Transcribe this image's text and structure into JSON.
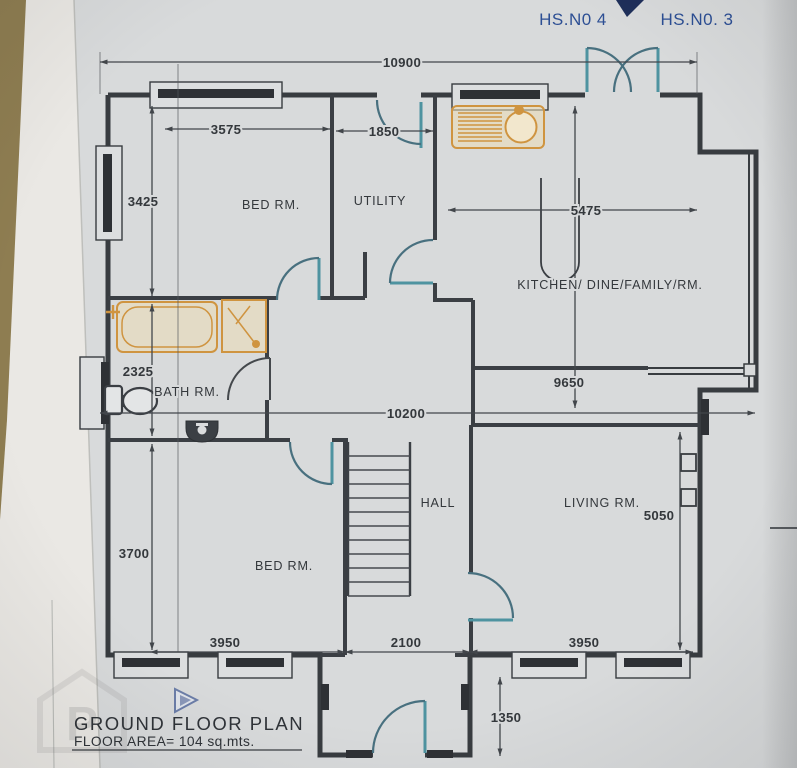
{
  "annotations": {
    "hs_no_4": "HS.N0 4",
    "hs_no_3": "HS.N0. 3"
  },
  "rooms": {
    "bed_front": "BED RM.",
    "utility": "UTILITY",
    "kitchen": "KITCHEN/ DINE/FAMILY/RM.",
    "bath": "BATH RM.",
    "hall": "HALL",
    "living": "LIVING RM.",
    "bed_back": "BED RM."
  },
  "dimensions": {
    "overall_width": "10900",
    "front_bed_width": "3575",
    "utility_width": "1850",
    "front_bed_depth": "3425",
    "kitchen_width": "5475",
    "bath_depth": "2325",
    "kitchen_depth": "9650",
    "internal_width": "10200",
    "back_bed_depth": "3700",
    "living_depth": "5050",
    "back_bed_width": "3950",
    "hall_width": "2100",
    "living_width": "3950",
    "porch_depth": "1350"
  },
  "title_block": {
    "title": "GROUND FLOOR PLAN",
    "floor_area": "FLOOR AREA= 104 sq.mts."
  },
  "colors": {
    "paper": "#d8dadb",
    "ink": "#383c40",
    "door_teal": "#4e93a0",
    "fixture_orange": "#cf9440",
    "annotation_blue": "#2d4f94",
    "table_wood": "#8e7d51"
  }
}
